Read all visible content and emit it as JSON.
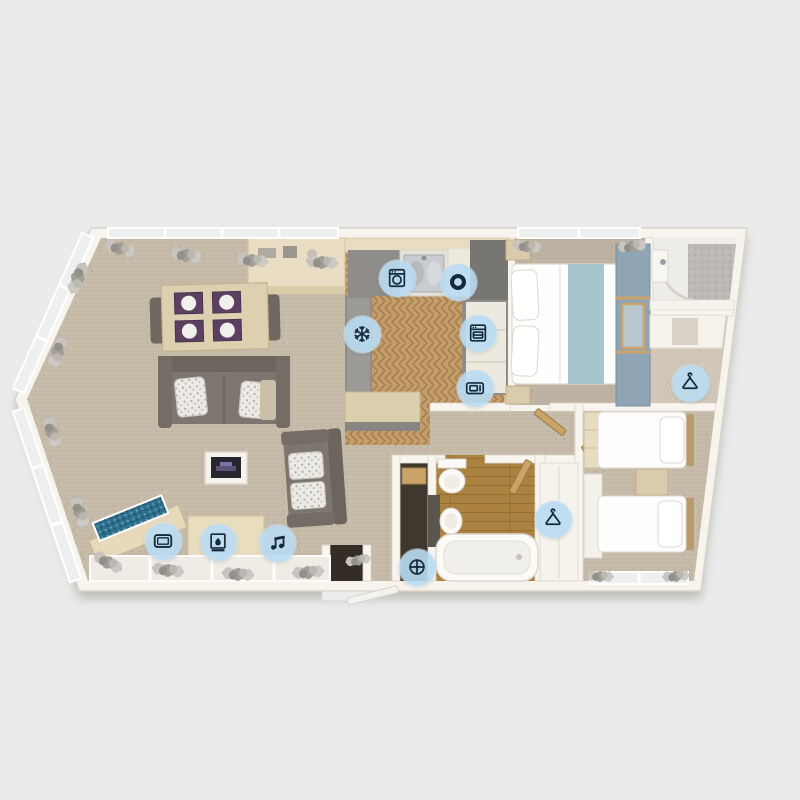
{
  "page": {
    "title": "holiday-lodge-floorplan",
    "description_visible_text": ""
  },
  "palette": {
    "page_background": "#ebebeb",
    "wall": "#f7f4ee",
    "carpet": "#c6bba9",
    "kitchen_wood": "#c49e6a",
    "bathroom_wood": "#ab8240",
    "sofa_gray": "#7d766e",
    "placemat_purple": "#5d4060",
    "bed_runner_teal": "#a6c4cc",
    "wardrobe_blue": "#8fa5b5",
    "icon_bg": "rgba(185,220,242,0.9)",
    "icon_glyph": "#16293b"
  },
  "feature_icons": [
    {
      "name": "washing-machine",
      "glyph": "washing-machine",
      "x": 397,
      "y": 278
    },
    {
      "name": "oven-hob",
      "glyph": "hob",
      "x": 458,
      "y": 282
    },
    {
      "name": "fridge-freezer",
      "glyph": "snowflake",
      "x": 362,
      "y": 334
    },
    {
      "name": "dishwasher",
      "glyph": "dishwasher",
      "x": 478,
      "y": 333
    },
    {
      "name": "microwave",
      "glyph": "microwave",
      "x": 475,
      "y": 388
    },
    {
      "name": "tv",
      "glyph": "tv",
      "x": 163,
      "y": 541
    },
    {
      "name": "fireplace",
      "glyph": "fireplace",
      "x": 218,
      "y": 542
    },
    {
      "name": "audio-system",
      "glyph": "music-note",
      "x": 277,
      "y": 543
    },
    {
      "name": "shower-point",
      "glyph": "shower",
      "x": 417,
      "y": 567
    },
    {
      "name": "wardrobe-hall",
      "glyph": "hanger",
      "x": 553,
      "y": 519
    },
    {
      "name": "wardrobe-master",
      "glyph": "hanger",
      "x": 690,
      "y": 383
    }
  ]
}
